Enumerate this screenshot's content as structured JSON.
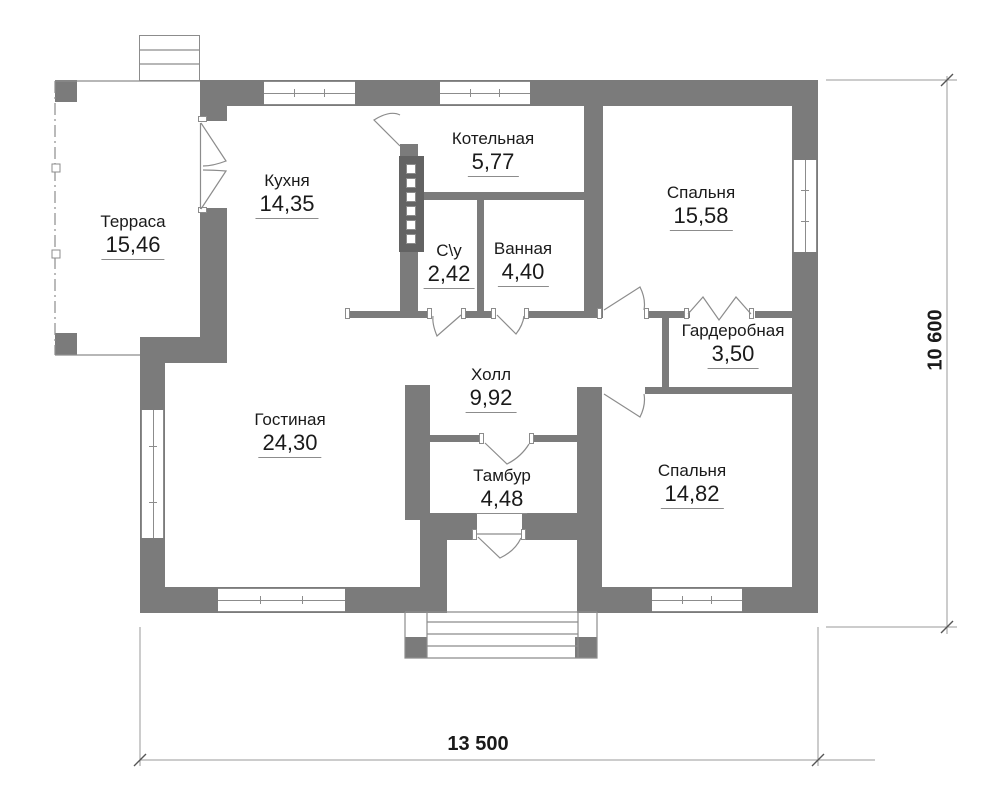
{
  "rooms": [
    {
      "name": "Терраса",
      "area": "15,46"
    },
    {
      "name": "Кухня",
      "area": "14,35"
    },
    {
      "name": "Котельная",
      "area": "5,77"
    },
    {
      "name": "С\\у",
      "area": "2,42"
    },
    {
      "name": "Ванная",
      "area": "4,40"
    },
    {
      "name": "Спальня",
      "area": "15,58"
    },
    {
      "name": "Гардеробная",
      "area": "3,50"
    },
    {
      "name": "Холл",
      "area": "9,92"
    },
    {
      "name": "Гостиная",
      "area": "24,30"
    },
    {
      "name": "Тамбур",
      "area": "4,48"
    },
    {
      "name": "Спальня",
      "area": "14,82"
    }
  ],
  "dimensions": {
    "width_label": "13 500",
    "height_label": "10 600"
  },
  "colors": {
    "wall": "#7b7b7b",
    "wall_dark": "#636363",
    "line": "#8c8c8c",
    "dim_line": "#9a9a9a",
    "ink": "#1a1a1a"
  }
}
